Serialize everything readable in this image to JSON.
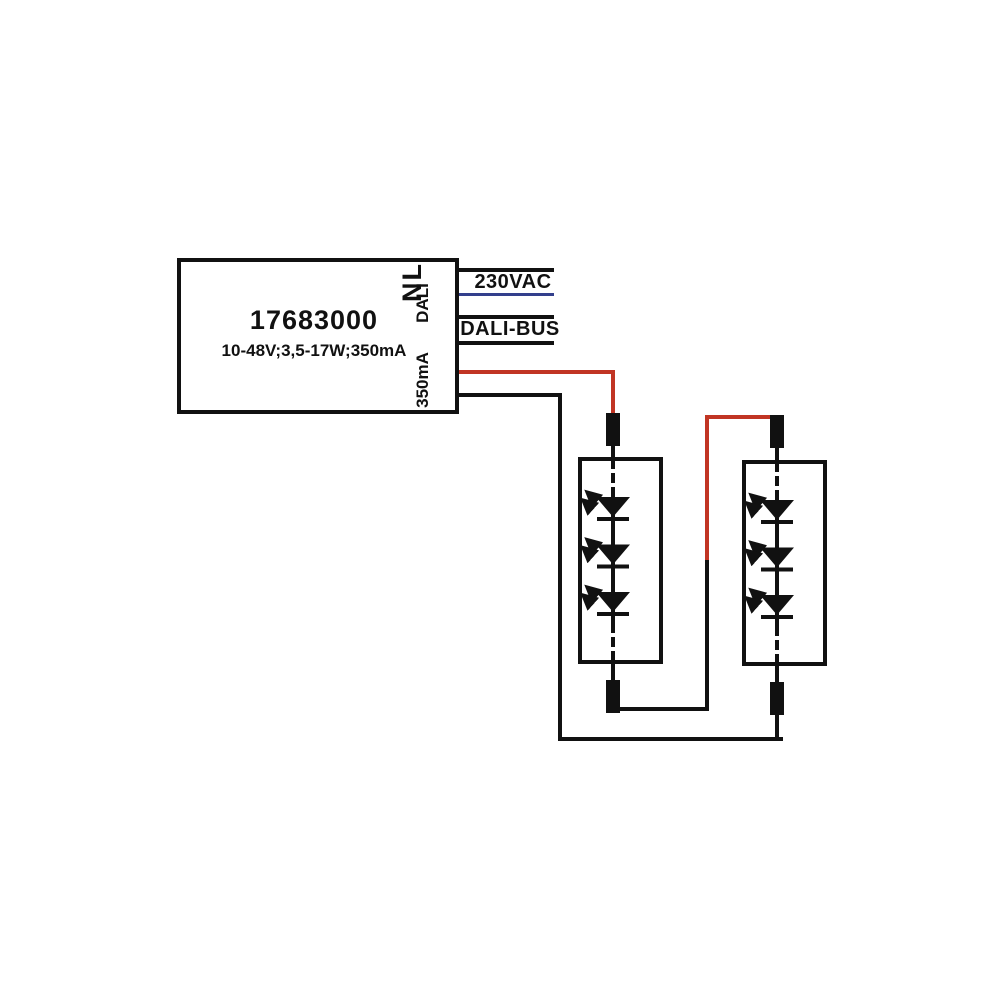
{
  "diagram": {
    "driver": {
      "part_number": "17683000",
      "specs": "10-48V;3,5-17W;350mA",
      "terminals": {
        "mains": "NL",
        "dali": "DALI",
        "output": "350mA"
      }
    },
    "wire_labels": {
      "mains": "230VAC",
      "dali_bus": "DALI-BUS"
    },
    "colors": {
      "wire_black": "#111111",
      "wire_red": "#c13524",
      "wire_blue": "#333f8c"
    },
    "modules": [
      {
        "name": "led-module-1",
        "led_count": 3
      },
      {
        "name": "led-module-2",
        "led_count": 3
      }
    ]
  }
}
